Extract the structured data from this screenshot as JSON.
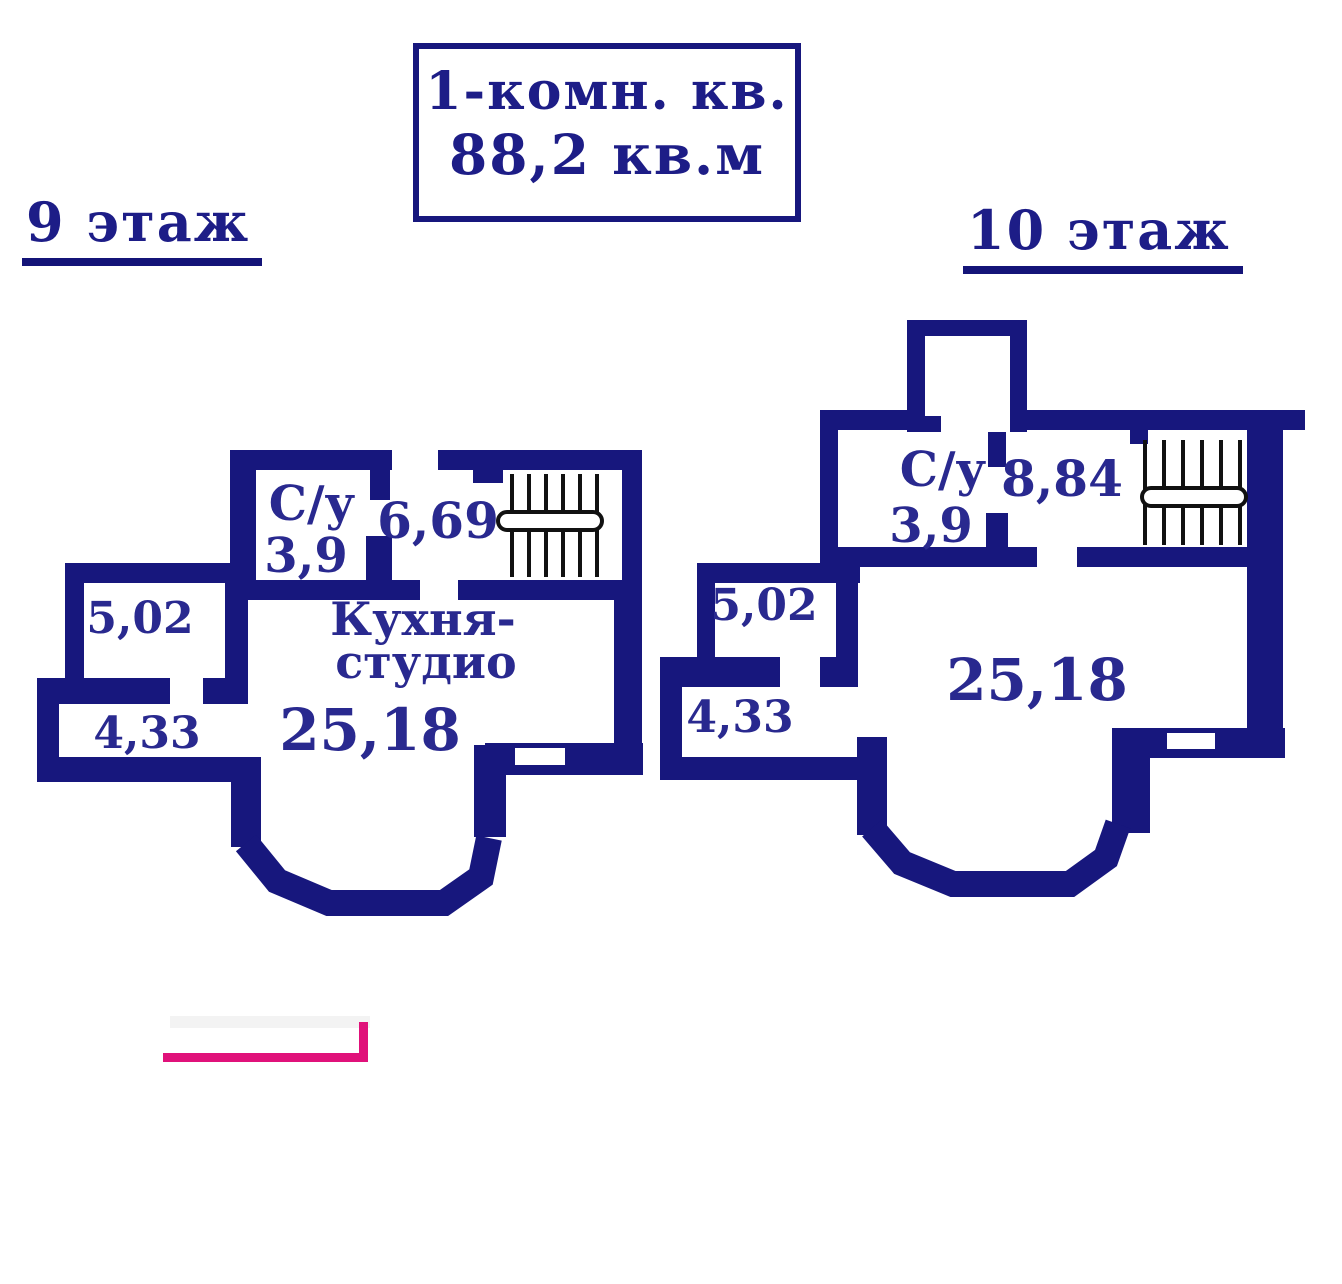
{
  "title": {
    "line1": "1-комн. кв.",
    "line2": "88,2 кв.м"
  },
  "floors": {
    "ninth": {
      "label": "9 этаж",
      "rooms": {
        "wc_label": "С/у",
        "wc_area": "3,9",
        "hall_area": "6,69",
        "storage_area": "5,02",
        "hallway_area": "4,33",
        "kitchen_name_line1": "Кухня-",
        "kitchen_name_line2": "студио",
        "kitchen_area": "25,18"
      }
    },
    "tenth": {
      "label": "10 этаж",
      "rooms": {
        "wc_label": "С/у",
        "wc_area": "3,9",
        "hall_area": "8,84",
        "storage_area": "5,02",
        "hallway_area": "4,33",
        "main_area": "25,18"
      }
    }
  },
  "colors": {
    "wall_navy": "#17177d",
    "label_navy": "#29298f",
    "stair_black": "#111111",
    "accent_pink": "#e0117a"
  }
}
